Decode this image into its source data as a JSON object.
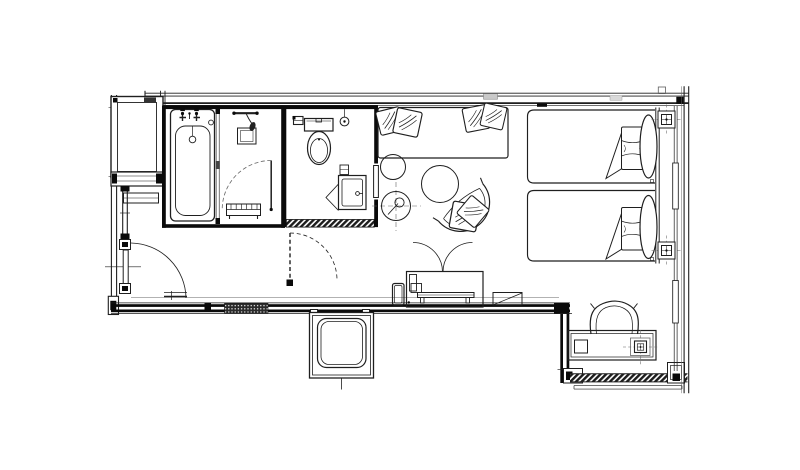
{
  "colors": {
    "background": "#ffffff",
    "line": "#1f1f1f",
    "wall": "#0a0a0a",
    "gray": "#666666",
    "hatch": "#1c1c1c",
    "tag": "#c9c9c9"
  },
  "plan": {
    "rooms": [
      "entry-vestibule",
      "corridor",
      "bathroom",
      "toilet-room",
      "living-area",
      "bedroom-area",
      "desk-nook"
    ],
    "fixtures": [
      "wardrobe",
      "storage-box",
      "shelf",
      "entrance-door",
      "door-swing-arc",
      "bathtub",
      "bath-taps",
      "overflow-drain",
      "glass-partition",
      "shower-unit",
      "shower-control-box",
      "bath-door",
      "slatted-bench",
      "toilet",
      "toilet-tank",
      "toilet-paper-holder",
      "flush-control",
      "washbasin-vanity",
      "toilet-room-door-panel",
      "corridor-sliding-door-dashed",
      "sofa-daybed",
      "decor-pillow",
      "side-table-small",
      "side-table-large",
      "floor-lamp-symbol",
      "lounge-chair",
      "seat-cushion",
      "mirror-panel",
      "storage-cabinet",
      "cabinet-door-arcs",
      "luggage-bench",
      "stool",
      "twin-bed-1",
      "twin-bed-2",
      "bed-pillow-roll",
      "pillow-flap",
      "headboard",
      "wall-light-symbol",
      "floor-outlet-symbol",
      "desk",
      "desk-chair",
      "desk-accessory-box",
      "bay-column",
      "window-hatch-band",
      "window-sill",
      "curtain-glass-wall",
      "wall-tag"
    ]
  }
}
